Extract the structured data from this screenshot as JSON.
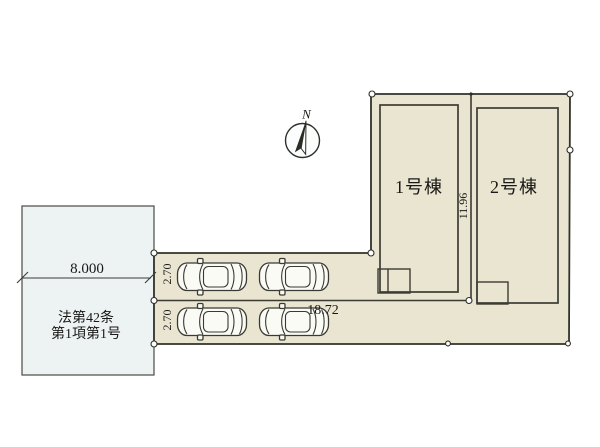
{
  "colors": {
    "site_fill": "#e9e5d1",
    "road_fill": "#edf2f3",
    "line": "#3c3c34",
    "text": "#191917"
  },
  "compass": {
    "north_label": "N"
  },
  "road": {
    "designation_line1": "法第42条",
    "designation_line2": "第1項第1号",
    "width_dimension": "8.000"
  },
  "site": {
    "lot_boundary_length": "18.72",
    "lot_divider_length": "11.96"
  },
  "parking": {
    "rows": [
      {
        "width_dimension": "2.70"
      },
      {
        "width_dimension": "2.70"
      }
    ],
    "car_count": 4
  },
  "buildings": [
    {
      "label": "1号棟"
    },
    {
      "label": "2号棟"
    }
  ]
}
